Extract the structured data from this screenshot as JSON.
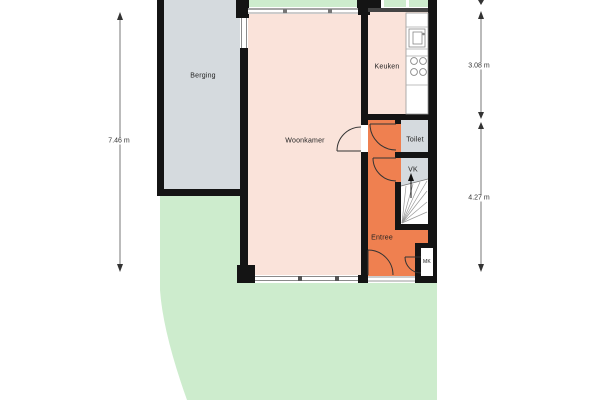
{
  "plan": {
    "rooms": {
      "berging": {
        "label": "Berging"
      },
      "woonkamer": {
        "label": "Woonkamer"
      },
      "keuken": {
        "label": "Keuken"
      },
      "toilet": {
        "label": "Toilet"
      },
      "vk": {
        "label": "VK"
      },
      "entree": {
        "label": "Entree"
      },
      "mk": {
        "label": "MK"
      }
    },
    "dimensions": {
      "left": "7.46 m",
      "right_top": "3.08 m",
      "right_bottom": "4.27 m"
    },
    "icons": {
      "stairs_direction": "up-arrow",
      "kitchen_fixtures": [
        "sink-icon",
        "stove-icon"
      ]
    },
    "colors": {
      "room_fill": "#fae3da",
      "entree_fill": "#ef8050",
      "service_fill": "#d5dade",
      "garden_fill": "#cdeccd",
      "wall": "#141414",
      "dim_line": "#555555",
      "window_line": "#8a8a8a"
    }
  }
}
